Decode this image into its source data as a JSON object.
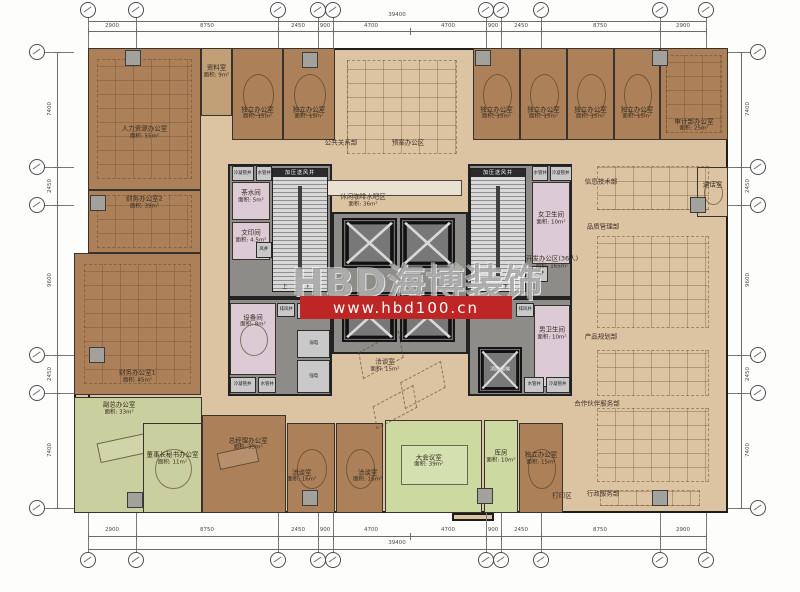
{
  "watermark": {
    "brand": "HBD海博装饰",
    "url": "www.hbd100.cn",
    "band_color": "#be2626",
    "brand_box": {
      "x": 292,
      "y": 252,
      "w": 230,
      "h": 48
    },
    "band_box": {
      "x": 300,
      "y": 296,
      "w": 212,
      "h": 23
    }
  },
  "palette": {
    "floor_tan": "#dcc3a2",
    "office_brown": "#ac8159",
    "exec_green": "#c9cf9e",
    "conference_green": "#ccd9a0",
    "service_pink": "#dccad4",
    "core_gray": "#8e8c88",
    "wall": "#1d1d1d"
  },
  "plan": {
    "outline": {
      "x": 88,
      "y": 48,
      "w": 640,
      "h": 465
    },
    "left_bump": {
      "x": 74,
      "y": 253,
      "w": 14,
      "h": 260
    },
    "bottom_step": {
      "x": 452,
      "y": 513,
      "w": 42,
      "h": 8
    },
    "cores": [
      {
        "x": 228,
        "y": 164,
        "w": 104,
        "h": 134
      },
      {
        "x": 468,
        "y": 164,
        "w": 104,
        "h": 134
      },
      {
        "x": 228,
        "y": 298,
        "w": 104,
        "h": 98
      },
      {
        "x": 468,
        "y": 298,
        "w": 104,
        "h": 98
      },
      {
        "x": 332,
        "y": 212,
        "w": 136,
        "h": 142
      }
    ],
    "rooms": [
      {
        "id": "hr-office",
        "name": "人力资源办公室",
        "area": "面积: 55m²",
        "x": 88,
        "y": 48,
        "w": 113,
        "h": 142,
        "cls": "brown",
        "furn": "cluster",
        "lab": [
          0.5,
          0.6
        ]
      },
      {
        "id": "archive-room",
        "name": "资料室",
        "area": "面积: 9m²",
        "x": 201,
        "y": 48,
        "w": 31,
        "h": 68,
        "cls": "brownl",
        "furn": "none",
        "lab": [
          0.5,
          0.35
        ]
      },
      {
        "id": "private-office-1",
        "name": "独立办公室",
        "area": "面积: 15m²",
        "x": 232,
        "y": 48,
        "w": 51,
        "h": 92,
        "cls": "brown",
        "furn": "meet",
        "lab": [
          0.5,
          0.72
        ]
      },
      {
        "id": "private-office-2",
        "name": "独立办公室",
        "area": "面积: 15m²",
        "x": 283,
        "y": 48,
        "w": 52,
        "h": 92,
        "cls": "brown",
        "furn": "meet",
        "lab": [
          0.5,
          0.72
        ]
      },
      {
        "id": "private-office-3",
        "name": "独立办公室",
        "area": "面积: 15m²",
        "x": 473,
        "y": 48,
        "w": 47,
        "h": 92,
        "cls": "brown",
        "furn": "meet",
        "lab": [
          0.5,
          0.72
        ]
      },
      {
        "id": "private-office-4",
        "name": "独立办公室",
        "area": "面积: 15m²",
        "x": 520,
        "y": 48,
        "w": 47,
        "h": 92,
        "cls": "brown",
        "furn": "meet",
        "lab": [
          0.5,
          0.72
        ]
      },
      {
        "id": "private-office-5",
        "name": "独立办公室",
        "area": "面积: 15m²",
        "x": 567,
        "y": 48,
        "w": 47,
        "h": 92,
        "cls": "brown",
        "furn": "meet",
        "lab": [
          0.5,
          0.72
        ]
      },
      {
        "id": "private-office-6",
        "name": "独立办公室",
        "area": "面积: 15m²",
        "x": 614,
        "y": 48,
        "w": 46,
        "h": 92,
        "cls": "brown",
        "furn": "meet",
        "lab": [
          0.5,
          0.72
        ]
      },
      {
        "id": "audit-office",
        "name": "审计部办公室",
        "area": "面积: 25m²",
        "x": 660,
        "y": 48,
        "w": 68,
        "h": 92,
        "cls": "brown",
        "furn": "cluster",
        "lab": [
          0.5,
          0.85
        ]
      },
      {
        "id": "finance-office-2",
        "name": "财务办公室2",
        "area": "面积: 39m²",
        "x": 88,
        "y": 190,
        "w": 113,
        "h": 63,
        "cls": "brown",
        "furn": "cluster",
        "lab": [
          0.5,
          0.2
        ]
      },
      {
        "id": "finance-office-1",
        "name": "财务办公室1",
        "area": "面积: 45m²",
        "x": 74,
        "y": 253,
        "w": 127,
        "h": 142,
        "cls": "brown",
        "furn": "cluster",
        "lab": [
          0.5,
          0.88
        ]
      },
      {
        "id": "vice-gm-office",
        "name": "副总办公室",
        "area": "面积: 33m²",
        "x": 74,
        "y": 397,
        "w": 128,
        "h": 116,
        "cls": "g1",
        "furn": "exec",
        "lab": [
          0.35,
          0.1
        ]
      },
      {
        "id": "chairman-secretary-office",
        "name": "董事长秘书办公室",
        "area": "面积: 11m²",
        "x": 143,
        "y": 423,
        "w": 59,
        "h": 90,
        "cls": "g1",
        "furn": "meet",
        "lab": [
          0.5,
          0.4
        ]
      },
      {
        "id": "gm-office",
        "name": "总经理办公室",
        "area": "面积: 35m²",
        "x": 202,
        "y": 415,
        "w": 84,
        "h": 98,
        "cls": "brown",
        "furn": "exec",
        "lab": [
          0.55,
          0.3
        ]
      },
      {
        "id": "talk-room-1",
        "name": "洽谈室",
        "area": "面积: 16m²",
        "x": 287,
        "y": 423,
        "w": 48,
        "h": 90,
        "cls": "brown",
        "furn": "meet",
        "lab": [
          0.3,
          0.6
        ]
      },
      {
        "id": "talk-room-2",
        "name": "洽谈室",
        "area": "面积: 16m²",
        "x": 336,
        "y": 423,
        "w": 47,
        "h": 90,
        "cls": "brown",
        "furn": "meet",
        "lab": [
          0.68,
          0.6
        ]
      },
      {
        "id": "main-conference-room",
        "name": "大会议室",
        "area": "面积: 39m²",
        "x": 385,
        "y": 420,
        "w": 97,
        "h": 93,
        "cls": "g2",
        "furn": "conf",
        "lab": [
          0.45,
          0.45
        ]
      },
      {
        "id": "storage-room",
        "name": "库房",
        "area": "面积: 10m²",
        "x": 484,
        "y": 420,
        "w": 34,
        "h": 93,
        "cls": "g2",
        "furn": "none",
        "lab": [
          0.5,
          0.4
        ]
      },
      {
        "id": "private-office-7",
        "name": "独立办公室",
        "area": "面积: 15m²",
        "x": 519,
        "y": 423,
        "w": 44,
        "h": 90,
        "cls": "brown",
        "furn": "meet",
        "lab": [
          0.5,
          0.4
        ]
      },
      {
        "id": "phone-room",
        "name": "通话室",
        "area": "",
        "x": 697,
        "y": 167,
        "w": 31,
        "h": 50,
        "cls": "tanroom",
        "furn": "meet",
        "lab": [
          0.5,
          0.35
        ]
      },
      {
        "id": "pantry",
        "name": "茶水间",
        "area": "面积: 5m²",
        "x": 232,
        "y": 182,
        "w": 38,
        "h": 38,
        "cls": "pink",
        "furn": "none",
        "lab": [
          0.5,
          0.4
        ]
      },
      {
        "id": "print-copy-room",
        "name": "文印间",
        "area": "面积: 4.5m²",
        "x": 232,
        "y": 222,
        "w": 38,
        "h": 38,
        "cls": "pink",
        "furn": "none",
        "lab": [
          0.5,
          0.4
        ]
      },
      {
        "id": "equipment-room",
        "name": "设备间",
        "area": "面积: 8m²",
        "x": 230,
        "y": 303,
        "w": 46,
        "h": 72,
        "cls": "pink",
        "furn": "meet",
        "lab": [
          0.5,
          0.25
        ]
      },
      {
        "id": "womens-toilet",
        "name": "女卫生间",
        "area": "面积: 10m²",
        "x": 532,
        "y": 182,
        "w": 38,
        "h": 82,
        "cls": "pink",
        "furn": "none",
        "lab": [
          0.5,
          0.45
        ]
      },
      {
        "id": "mens-toilet",
        "name": "男卫生间",
        "area": "面积: 10m²",
        "x": 534,
        "y": 305,
        "w": 36,
        "h": 82,
        "cls": "pink",
        "furn": "none",
        "lab": [
          0.5,
          0.35
        ]
      }
    ],
    "shafts": [
      {
        "id": "condensate-shaft-1",
        "name": "冷凝管井",
        "x": 232,
        "y": 166,
        "w": 22,
        "h": 15
      },
      {
        "id": "water-shaft-1",
        "name": "水管井",
        "x": 256,
        "y": 166,
        "w": 16,
        "h": 15
      },
      {
        "id": "air-shaft-1",
        "name": "风井",
        "x": 256,
        "y": 242,
        "w": 16,
        "h": 16
      },
      {
        "id": "exhaust-shaft-1",
        "name": "排风井",
        "x": 277,
        "y": 303,
        "w": 18,
        "h": 14
      },
      {
        "id": "vestibule",
        "name": "前室",
        "x": 297,
        "y": 303,
        "w": 33,
        "h": 16
      },
      {
        "id": "elv-room",
        "name": "弱电",
        "x": 297,
        "y": 330,
        "w": 33,
        "h": 28
      },
      {
        "id": "power-room",
        "name": "强电",
        "x": 297,
        "y": 360,
        "w": 33,
        "h": 33
      },
      {
        "id": "condensate-shaft-2",
        "name": "冷凝管井",
        "x": 230,
        "y": 377,
        "w": 26,
        "h": 16
      },
      {
        "id": "water-shaft-2",
        "name": "水管井",
        "x": 258,
        "y": 377,
        "w": 18,
        "h": 16
      },
      {
        "id": "water-shaft-3",
        "name": "水管井",
        "x": 532,
        "y": 166,
        "w": 16,
        "h": 15
      },
      {
        "id": "condensate-shaft-3",
        "name": "冷凝管井",
        "x": 550,
        "y": 166,
        "w": 22,
        "h": 15
      },
      {
        "id": "air-shaft-2",
        "name": "风井",
        "x": 532,
        "y": 266,
        "w": 16,
        "h": 16
      },
      {
        "id": "exhaust-shaft-2",
        "name": "排风井",
        "x": 516,
        "y": 303,
        "w": 18,
        "h": 14
      },
      {
        "id": "water-shaft-4",
        "name": "水管井",
        "x": 524,
        "y": 377,
        "w": 20,
        "h": 16
      },
      {
        "id": "condensate-shaft-4",
        "name": "冷凝管井",
        "x": 546,
        "y": 377,
        "w": 24,
        "h": 16
      }
    ],
    "stairs": [
      {
        "id": "stair-west",
        "label": "加压送风井",
        "updown": "上  下",
        "x": 272,
        "y": 168,
        "w": 56,
        "h": 124
      },
      {
        "id": "stair-east",
        "label": "加压送风井",
        "updown": "上  下",
        "x": 470,
        "y": 168,
        "w": 56,
        "h": 124
      }
    ],
    "lifts": [
      {
        "id": "elevator-1",
        "x": 342,
        "y": 218,
        "w": 55,
        "h": 50,
        "label": ""
      },
      {
        "id": "elevator-2",
        "x": 400,
        "y": 218,
        "w": 55,
        "h": 50,
        "label": ""
      },
      {
        "id": "elevator-3",
        "x": 342,
        "y": 292,
        "w": 55,
        "h": 50,
        "label": ""
      },
      {
        "id": "elevator-4",
        "x": 400,
        "y": 292,
        "w": 55,
        "h": 50,
        "label": ""
      },
      {
        "id": "fire-elevator",
        "x": 478,
        "y": 347,
        "w": 44,
        "h": 46,
        "label": "消防电梯"
      }
    ],
    "columns": [
      {
        "x": 133,
        "y": 58
      },
      {
        "x": 310,
        "y": 60
      },
      {
        "x": 483,
        "y": 58
      },
      {
        "x": 660,
        "y": 58
      },
      {
        "x": 98,
        "y": 203
      },
      {
        "x": 97,
        "y": 355
      },
      {
        "x": 135,
        "y": 500
      },
      {
        "x": 310,
        "y": 498
      },
      {
        "x": 485,
        "y": 496
      },
      {
        "x": 660,
        "y": 498
      },
      {
        "x": 698,
        "y": 205
      }
    ],
    "furniture": [
      {
        "kind": "cluster",
        "x": 347,
        "y": 60,
        "w": 110,
        "h": 94
      },
      {
        "kind": "cluster",
        "x": 597,
        "y": 166,
        "w": 112,
        "h": 44
      },
      {
        "kind": "cluster",
        "x": 597,
        "y": 236,
        "w": 112,
        "h": 92
      },
      {
        "kind": "cluster",
        "x": 597,
        "y": 350,
        "w": 112,
        "h": 46
      },
      {
        "kind": "cluster",
        "x": 597,
        "y": 408,
        "w": 112,
        "h": 74
      },
      {
        "kind": "cluster",
        "x": 600,
        "y": 490,
        "w": 100,
        "h": 16
      },
      {
        "kind": "bar",
        "x": 312,
        "y": 180,
        "w": 150,
        "h": 16
      },
      {
        "kind": "hex",
        "x": 358,
        "y": 342,
        "w": 46,
        "h": 26
      },
      {
        "kind": "hex",
        "x": 400,
        "y": 372,
        "w": 46,
        "h": 26
      },
      {
        "kind": "hex",
        "x": 372,
        "y": 396,
        "w": 46,
        "h": 22
      }
    ],
    "open_labels": [
      {
        "id": "label-public-relations",
        "t": "公共关系部",
        "a": "",
        "x": 341,
        "y": 143
      },
      {
        "id": "label-plan-office-area",
        "t": "预案办公区",
        "a": "",
        "x": 408,
        "y": 143
      },
      {
        "id": "label-coffee-bar-area",
        "t": "休闲咖啡水吧区",
        "a": "面积: 36m²",
        "x": 363,
        "y": 201
      },
      {
        "id": "label-center-talk-room",
        "t": "洽谈室",
        "a": "面积: 15m²",
        "x": 385,
        "y": 366
      },
      {
        "id": "label-it-department",
        "t": "信息技术部",
        "a": "",
        "x": 601,
        "y": 182
      },
      {
        "id": "label-quality-management",
        "t": "品质管理部",
        "a": "",
        "x": 603,
        "y": 227
      },
      {
        "id": "label-dev-office-area",
        "t": "开发办公区(36人)",
        "a": "面积: 165m²",
        "x": 552,
        "y": 263
      },
      {
        "id": "label-product-planning",
        "t": "产品规划部",
        "a": "",
        "x": 601,
        "y": 337
      },
      {
        "id": "label-partner-services",
        "t": "合作伙伴服务部",
        "a": "",
        "x": 597,
        "y": 404
      },
      {
        "id": "label-admin-services",
        "t": "行政服务部",
        "a": "",
        "x": 603,
        "y": 494
      },
      {
        "id": "label-print-area",
        "t": "打印区",
        "a": "",
        "x": 562,
        "y": 496
      }
    ]
  },
  "dims": {
    "top": {
      "total": {
        "t": "39400",
        "x": 397,
        "y": 15
      },
      "total_line_y": 21,
      "seg_line_y": 31,
      "seg_label_y": 26,
      "ticks": [
        88,
        136,
        278,
        318,
        333,
        410,
        486,
        501,
        541,
        660,
        706
      ],
      "segments": [
        {
          "t": "2900",
          "x": 112
        },
        {
          "t": "8750",
          "x": 207
        },
        {
          "t": "2450",
          "x": 298
        },
        {
          "t": "900",
          "x": 325
        },
        {
          "t": "4700",
          "x": 371
        },
        {
          "t": "4700",
          "x": 448
        },
        {
          "t": "900",
          "x": 493
        },
        {
          "t": "2450",
          "x": 521
        },
        {
          "t": "8750",
          "x": 600
        },
        {
          "t": "2900",
          "x": 683
        }
      ]
    },
    "bottom": {
      "total": {
        "t": "39400",
        "x": 397,
        "y": 543
      },
      "total_line_y": 549,
      "seg_line_y": 536,
      "seg_label_y": 530,
      "ticks": [
        88,
        136,
        278,
        318,
        333,
        410,
        486,
        501,
        541,
        660,
        706
      ],
      "segments": [
        {
          "t": "2900",
          "x": 112
        },
        {
          "t": "8750",
          "x": 207
        },
        {
          "t": "2450",
          "x": 298
        },
        {
          "t": "900",
          "x": 325
        },
        {
          "t": "4700",
          "x": 371
        },
        {
          "t": "4700",
          "x": 448
        },
        {
          "t": "900",
          "x": 493
        },
        {
          "t": "2450",
          "x": 521
        },
        {
          "t": "8750",
          "x": 600
        },
        {
          "t": "2900",
          "x": 683
        }
      ]
    },
    "left": {
      "line_x": 57,
      "label_x": 50,
      "ticks": [
        52,
        167,
        205,
        355,
        393,
        508
      ],
      "segments": [
        {
          "t": "7400",
          "y": 109
        },
        {
          "t": "2450",
          "y": 186
        },
        {
          "t": "9600",
          "y": 280
        },
        {
          "t": "2450",
          "y": 374
        },
        {
          "t": "7400",
          "y": 450
        }
      ]
    },
    "right": {
      "line_x": 741,
      "label_x": 748,
      "ticks": [
        52,
        167,
        205,
        355,
        393,
        508
      ],
      "segments": [
        {
          "t": "7400",
          "y": 109
        },
        {
          "t": "2450",
          "y": 186
        },
        {
          "t": "9600",
          "y": 280
        },
        {
          "t": "2450",
          "y": 374
        },
        {
          "t": "7400",
          "y": 450
        }
      ]
    }
  },
  "grid": {
    "top_bubbles_y": 10,
    "bottom_bubbles_y": 560,
    "col_x": [
      88,
      136,
      278,
      318,
      333,
      486,
      501,
      541,
      660,
      706
    ],
    "left_bubbles_x": 37,
    "right_bubbles_x": 758,
    "row_y": [
      52,
      167,
      205,
      355,
      393,
      508
    ]
  }
}
